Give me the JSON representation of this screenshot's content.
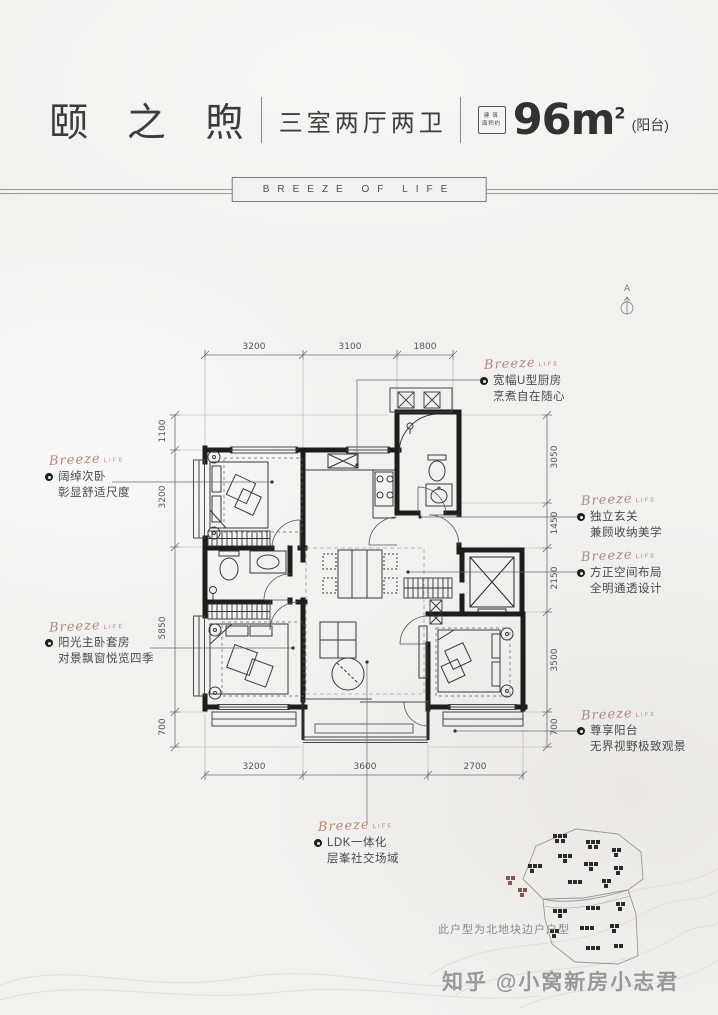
{
  "header": {
    "title": "颐 之 煦",
    "subtitle": "三室两厅两卫",
    "badge_line1": "建 筑",
    "badge_line2": "面积约",
    "area_value": "96m",
    "area_sup": "2",
    "area_suffix": "(阳台)",
    "banner": "BREEZE OF LIFE"
  },
  "compass_label": "A",
  "annotation_flourish": {
    "main": "Breeze",
    "sub": "LIFE"
  },
  "annotations": {
    "kitchen": {
      "line1": "宽幅U型厨房",
      "line2": "烹煮自在随心"
    },
    "bedroom2": {
      "line1": "阔绰次卧",
      "line2": "彰显舒适尺度"
    },
    "entry": {
      "line1": "独立玄关",
      "line2": "兼顾收纳美学"
    },
    "layout": {
      "line1": "方正空间布局",
      "line2": "全明通透设计"
    },
    "master": {
      "line1": "阳光主卧套房",
      "line2": "对景飘窗悦览四季"
    },
    "balcony": {
      "line1": "尊享阳台",
      "line2": "无界视野极致观景"
    },
    "ldk": {
      "line1": "LDK一体化",
      "line2": "层峯社交场域"
    }
  },
  "dimensions": {
    "top": [
      "3200",
      "3100",
      "1800"
    ],
    "bottom": [
      "3200",
      "3600",
      "2700"
    ],
    "left": [
      "1100",
      "3200",
      "5850",
      "700"
    ],
    "right": [
      "3050",
      "1450",
      "2150",
      "3500",
      "700"
    ]
  },
  "site_plan": {
    "caption": "此户型为北地块边户户型"
  },
  "watermark": "知乎 @小窝新房小志君",
  "colors": {
    "accent_script": "#b5897a",
    "plan_line": "#1d1d1d",
    "highlight_building": "#8a5742"
  }
}
